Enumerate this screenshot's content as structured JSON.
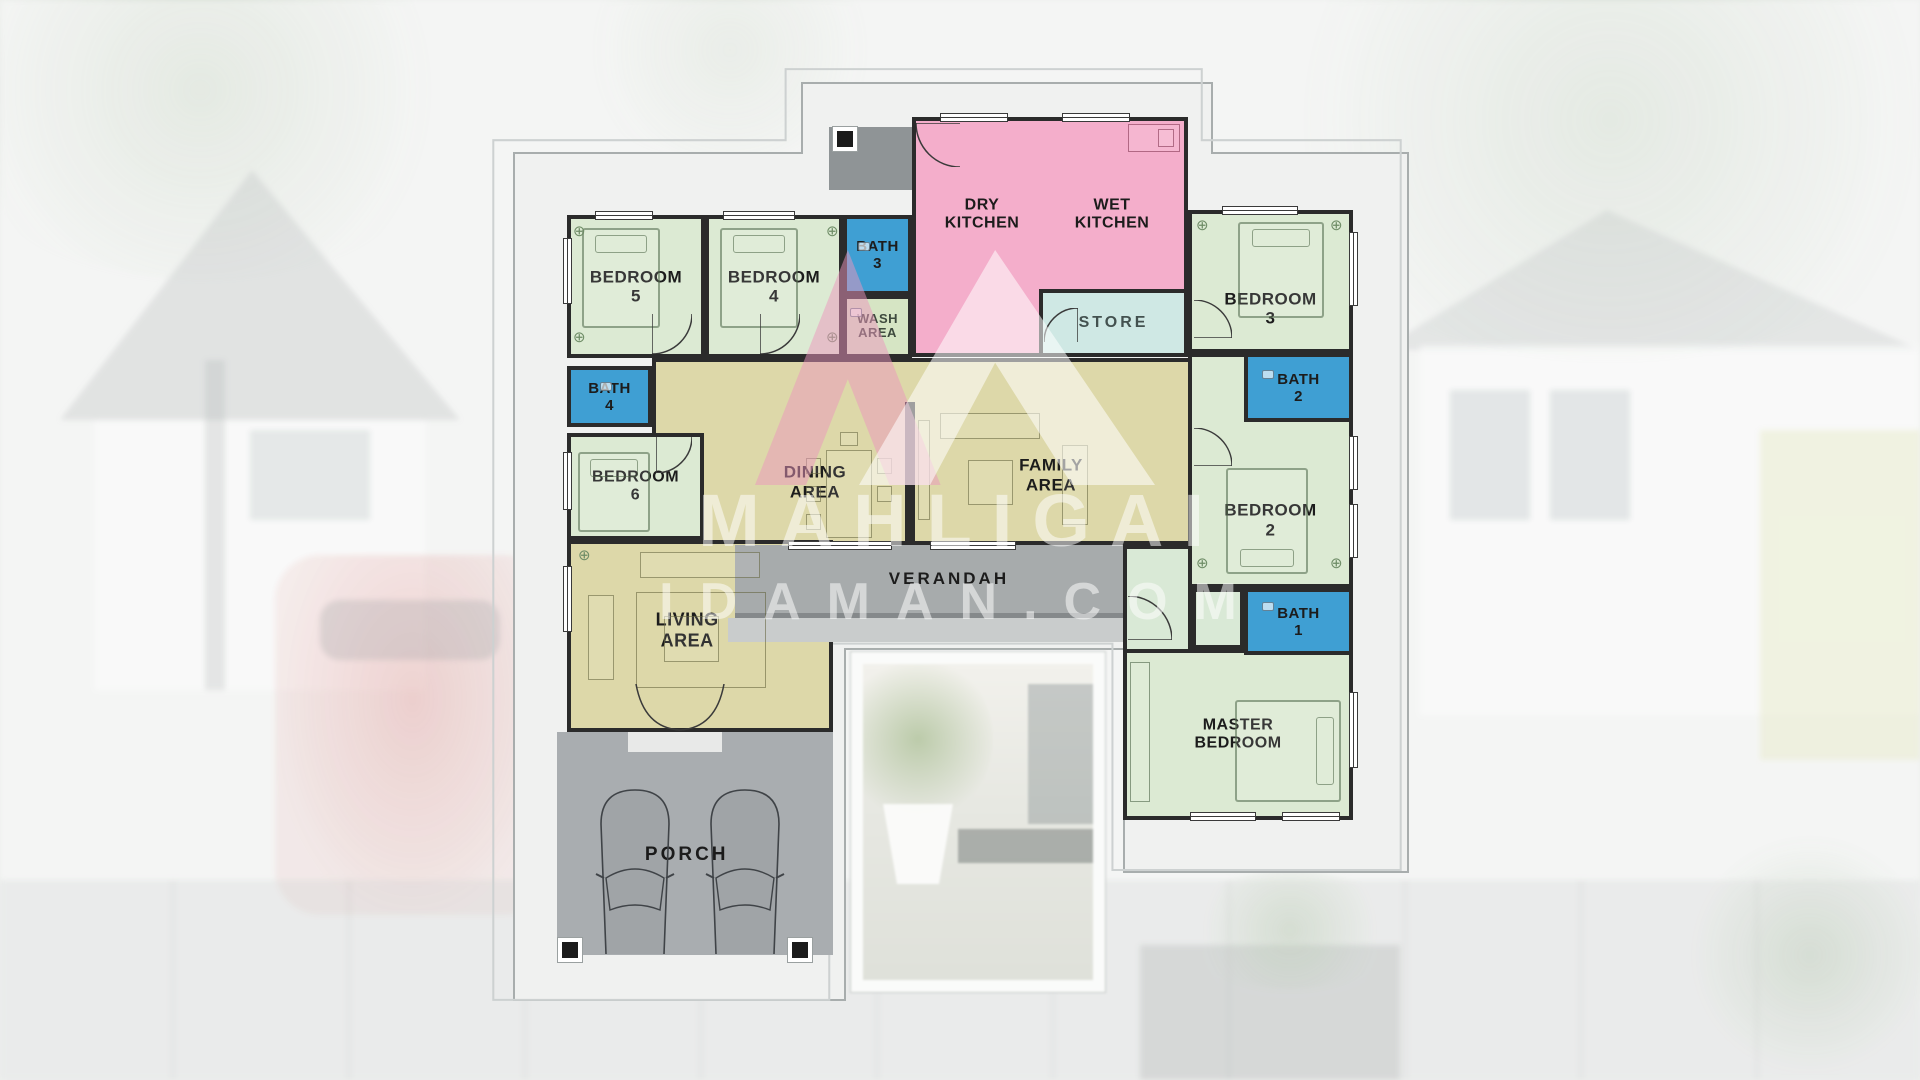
{
  "watermark": {
    "line1": "MAHLIGAI",
    "line2": "IDAMAN.COM"
  },
  "colors": {
    "green": "#dcead3",
    "green2": "#d9e9d6",
    "blue": "#3f9fd3",
    "pink": "#f4aecb",
    "teal": "#cfe8e4",
    "khaki": "#ddd8a9",
    "wash": "#d6e5c4",
    "verandah": "#a7abac",
    "steps": "#c9cccc",
    "porch": "#a9adb0",
    "porchstep": "#e8e9e8",
    "vestibule": "#8f9496",
    "wall": "#2b2b2b",
    "mat": "#f0f1f0",
    "logo_pink": "#ec96be",
    "none": "transparent"
  },
  "rooms": [
    {
      "id": "hall",
      "label": "",
      "x": 652,
      "y": 358,
      "w": 540,
      "h": 187,
      "fill": "khaki",
      "wall": true
    },
    {
      "id": "living",
      "label": "LIVING\nAREA",
      "x": 567,
      "y": 540,
      "w": 266,
      "h": 192,
      "fill": "khaki",
      "wall": true,
      "lx": 45,
      "ly": 47,
      "fs": 18
    },
    {
      "id": "verandah",
      "label": "VERANDAH",
      "x": 735,
      "y": 545,
      "w": 389,
      "h": 73,
      "fill": "verandah",
      "wall": false,
      "cls": "verandah",
      "lx": 55,
      "ly": 50,
      "fs": 17,
      "ls": 3
    },
    {
      "id": "verandah-steps",
      "label": "",
      "x": 728,
      "y": 618,
      "w": 396,
      "h": 24,
      "fill": "steps",
      "wall": false
    },
    {
      "id": "porch",
      "label": "PORCH",
      "x": 557,
      "y": 732,
      "w": 276,
      "h": 223,
      "fill": "porch",
      "wall": false,
      "lx": 47,
      "ly": 55,
      "fs": 19,
      "ls": 3
    },
    {
      "id": "porch-step",
      "label": "",
      "x": 628,
      "y": 732,
      "w": 94,
      "h": 20,
      "fill": "porchstep",
      "wall": false
    },
    {
      "id": "vestibule",
      "label": "",
      "x": 829,
      "y": 127,
      "w": 83,
      "h": 63,
      "fill": "vestibule",
      "wall": false
    },
    {
      "id": "kitchen",
      "label": "",
      "x": 912,
      "y": 117,
      "w": 276,
      "h": 240,
      "fill": "pink",
      "wall": true
    },
    {
      "id": "store",
      "label": "STORE",
      "x": 1039,
      "y": 289,
      "w": 149,
      "h": 68,
      "fill": "teal",
      "wall": true,
      "fs": 16,
      "ls": 3,
      "lcolor": "#43514f"
    },
    {
      "id": "bedroom5",
      "label": "BEDROOM 5",
      "x": 567,
      "y": 215,
      "w": 138,
      "h": 143,
      "fill": "green",
      "wall": true,
      "fs": 17
    },
    {
      "id": "bedroom4",
      "label": "BEDROOM 4",
      "x": 705,
      "y": 215,
      "w": 138,
      "h": 143,
      "fill": "green",
      "wall": true,
      "fs": 17
    },
    {
      "id": "bath3",
      "label": "BATH\n3",
      "x": 843,
      "y": 215,
      "w": 69,
      "h": 80,
      "fill": "blue",
      "wall": true,
      "fs": 15
    },
    {
      "id": "wash-area",
      "label": "WASH\nAREA",
      "x": 843,
      "y": 295,
      "w": 69,
      "h": 63,
      "fill": "wash",
      "wall": true,
      "fs": 13,
      "lcolor": "#3e4a3e"
    },
    {
      "id": "bedroom3",
      "label": "BEDROOM 3",
      "x": 1188,
      "y": 210,
      "w": 165,
      "h": 143,
      "fill": "green",
      "wall": true,
      "ly": 70,
      "fs": 17
    },
    {
      "id": "bedroom2",
      "label": "BEDROOM 2",
      "x": 1188,
      "y": 353,
      "w": 165,
      "h": 235,
      "fill": "green",
      "wall": true,
      "ly": 72,
      "fs": 17
    },
    {
      "id": "bath2",
      "label": "BATH 2",
      "x": 1244,
      "y": 353,
      "w": 109,
      "h": 69,
      "fill": "blue",
      "wall": true,
      "fs": 15
    },
    {
      "id": "nook",
      "label": "",
      "x": 1192,
      "y": 588,
      "w": 52,
      "h": 61,
      "fill": "green2",
      "wall": true
    },
    {
      "id": "master-corridor",
      "label": "",
      "x": 1123,
      "y": 545,
      "w": 69,
      "h": 275,
      "fill": "green2",
      "wall": true
    },
    {
      "id": "master-bedroom",
      "label": "MASTER\nBEDROOM",
      "x": 1123,
      "y": 649,
      "w": 230,
      "h": 171,
      "fill": "green",
      "wall": true,
      "fs": 16
    },
    {
      "id": "bath1",
      "label": "BATH 1",
      "x": 1244,
      "y": 588,
      "w": 109,
      "h": 67,
      "fill": "blue",
      "wall": true,
      "fs": 15
    },
    {
      "id": "bath4",
      "label": "BATH 4",
      "x": 567,
      "y": 366,
      "w": 85,
      "h": 61,
      "fill": "blue",
      "wall": true,
      "fs": 15
    },
    {
      "id": "bedroom6",
      "label": "BEDROOM 6",
      "x": 567,
      "y": 433,
      "w": 137,
      "h": 107,
      "fill": "green",
      "wall": true,
      "fs": 16
    },
    {
      "id": "dry-kitchen",
      "label": "DRY\nKITCHEN",
      "x": 912,
      "y": 150,
      "w": 140,
      "h": 130,
      "fill": "none",
      "wall": false,
      "fs": 16
    },
    {
      "id": "wet-kitchen",
      "label": "WET\nKITCHEN",
      "x": 1042,
      "y": 150,
      "w": 140,
      "h": 130,
      "fill": "none",
      "wall": false,
      "fs": 16
    },
    {
      "id": "dining-area",
      "label": "DINING AREA",
      "x": 715,
      "y": 460,
      "w": 200,
      "h": 44,
      "fill": "none",
      "wall": false,
      "fs": 17
    },
    {
      "id": "family-area",
      "label": "FAMILY AREA",
      "x": 951,
      "y": 453,
      "w": 200,
      "h": 44,
      "fill": "none",
      "wall": false,
      "fs": 17
    }
  ]
}
